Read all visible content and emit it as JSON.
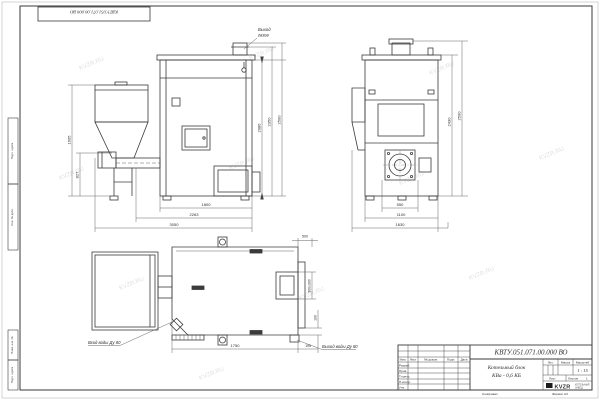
{
  "sheet": {
    "watermark": "KVZR.RU",
    "footer_copied": "Копировал",
    "footer_format": "Формат А3",
    "top_stamp_doc": "КВТУ.051.071.00.000 ВО",
    "margin_box1": "Подп. и дата",
    "margin_box2": "Инв. № дубл.",
    "margin_box3": "Взам. инв. №",
    "margin_box4": "Подп. и дата"
  },
  "views": {
    "front": {
      "label_outlet_line1": "Выход",
      "label_outlet_line2": "газов",
      "dim_h_inner": "2086",
      "dim_h_mid": "2350",
      "dim_h_outer": "2500",
      "dim_left_outer": "1605",
      "dim_left_inner": "827",
      "dim_w_body": "1800",
      "dim_w_mid": "2263",
      "dim_w_total": "3050"
    },
    "side": {
      "dim_w_inner": "550",
      "dim_w_mid": "1100",
      "dim_w_total": "1630",
      "dim_h_inner": "2430",
      "dim_h_outer": "2500"
    },
    "plan": {
      "label_inlet": "Вход воды Ду 80",
      "label_outlet": "Выход воды Ду 80",
      "dim_length": "1750",
      "dim_offset": "195",
      "dim_top": "500",
      "dim_hatch": "300х300",
      "dim_right": "100"
    }
  },
  "title_block": {
    "doc_number": "КВТУ.051.071.00.000 ВО",
    "name_line1": "Котельный блок",
    "name_line2": "КВа - 0,6 КБ",
    "col_izm": "Изм.",
    "col_list": "Лист",
    "col_doc": "№ докум.",
    "col_sign": "Подп.",
    "col_date": "Дата",
    "row_razrab": "Разраб.",
    "row_prov": "Пров.",
    "row_tkontr": "Т.контр.",
    "row_nkontr": "Н.контр.",
    "row_utv": "Утв.",
    "lit_label": "Лит.",
    "mass_label": "Масса",
    "scale_label": "Масштаб",
    "scale_value": "1 : 15",
    "sheet_label": "Лист",
    "sheets_label": "Листов",
    "sheets_value": "1",
    "logo_text": "KVZR",
    "logo_sub1": "КОТЕЛЬНЫЙ",
    "logo_sub2": "ЗАВОД"
  }
}
